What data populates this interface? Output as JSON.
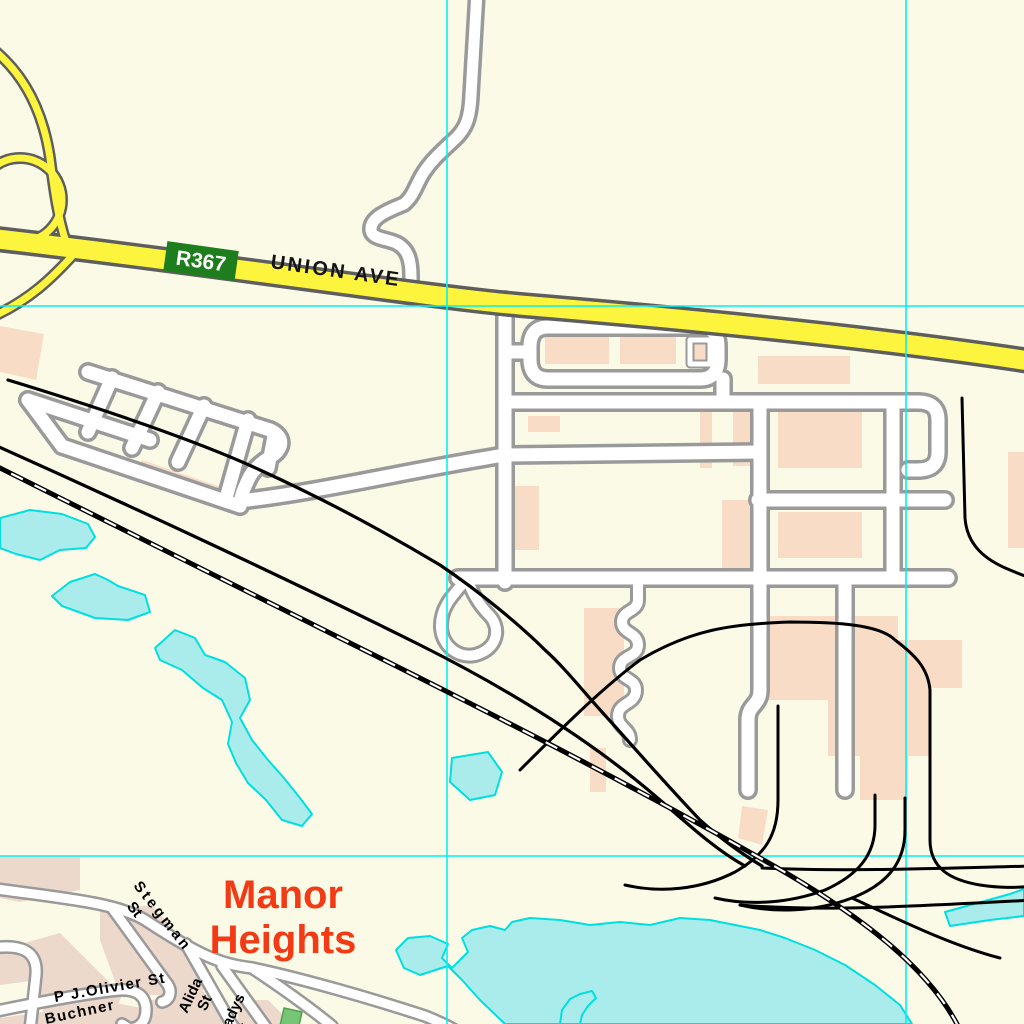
{
  "map": {
    "labels": {
      "route_shield": "R367",
      "avenue": "UNION AVE",
      "suburb_line1": "Manor",
      "suburb_line2": "Heights",
      "stegman_line1": "Stegman",
      "stegman_line2": "St",
      "olivier": "P J.Olivier St",
      "buchner": "Buchner",
      "alida_line1": "Alida",
      "alida_line2": "St",
      "gladys_line1": "Gladys",
      "gladys_line2": "St"
    },
    "grid": {
      "v1": 447,
      "v2": 906,
      "h1": 306,
      "h2": 856
    }
  },
  "colors": {
    "background": "#FBFAE7",
    "land_residential": "#EDD8CC",
    "building": "#F9DCC6",
    "water_fill": "#A9ECEB",
    "water_outline": "#00DFDF",
    "grid_line": "#00F2F2",
    "road_major_fill": "#FDF53D",
    "road_major_casing": "#5E5E5E",
    "road_minor_fill": "#FFFFFF",
    "road_minor_casing": "#9A9A9A",
    "railway": "#000000",
    "railway_dash": "#FFFFFF",
    "route_shield_bg": "#1E7E1E",
    "route_shield_text": "#FFFFFF",
    "road_label_text": "#141414",
    "street_label_text": "#000000",
    "suburb_label_text": "#F23A14",
    "park_green": "#77C577",
    "park_outline": "#4FA24F"
  }
}
